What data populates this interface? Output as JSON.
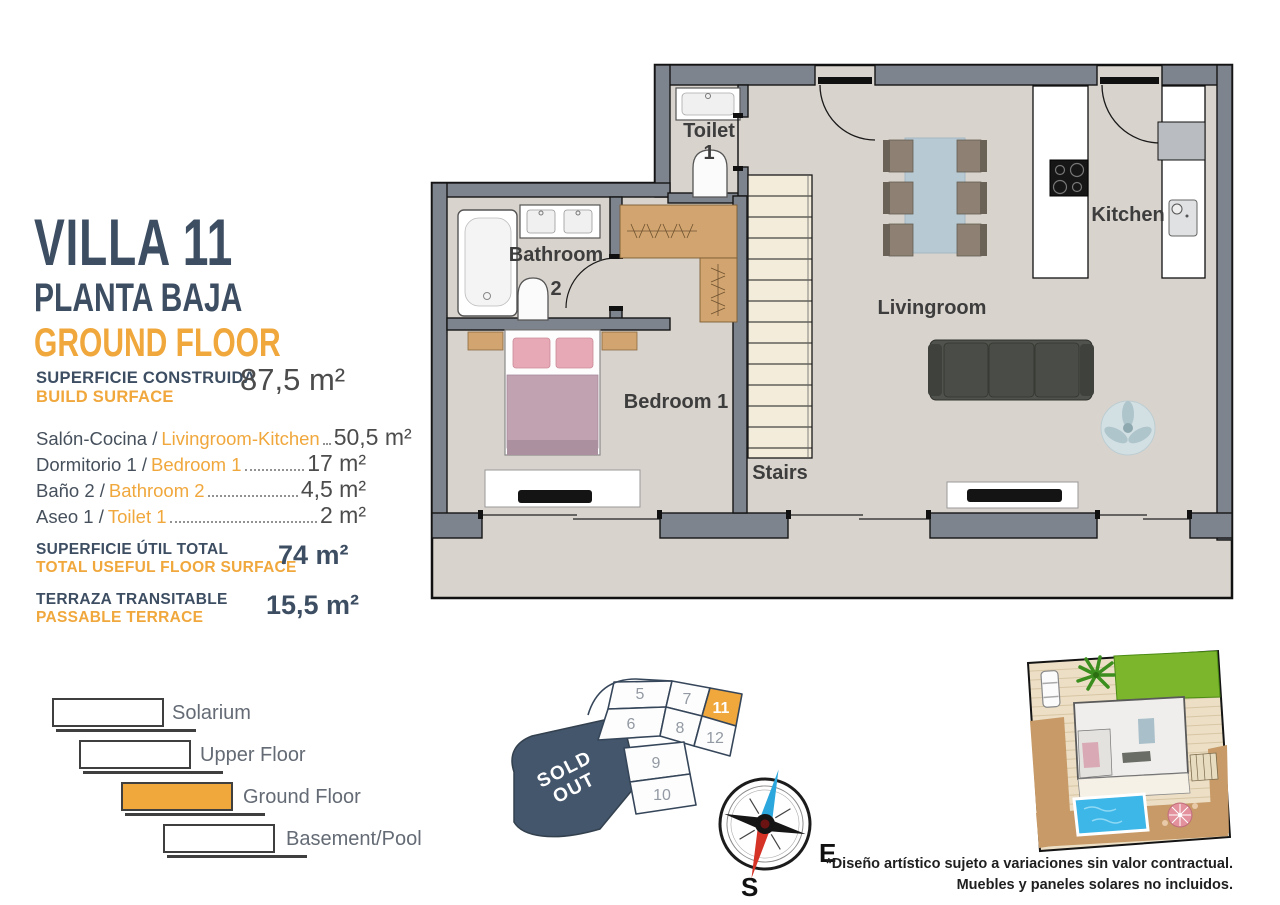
{
  "colors": {
    "navy": "#3D4E63",
    "orange": "#F0A73C",
    "wall_gray": "#7E848E",
    "floor_beige": "#D9D3CD",
    "sold_navy": "#44566C",
    "pool_blue": "#3DB6E8",
    "lawn_green": "#7CB62C",
    "stairs_cream": "#F3ECDA",
    "wood_tan": "#D2A46F"
  },
  "panel": {
    "title": "VILLA 11",
    "subtitle_es": "PLANTA BAJA",
    "subtitle_en": "GROUND FLOOR",
    "build_surface": {
      "label_es": "SUPERFICIE CONSTRUIDA",
      "label_en": "BUILD SURFACE",
      "value": "87,5 m²"
    },
    "rooms": [
      {
        "es": "Salón-Cocina /",
        "en": "Livingroom-Kitchen",
        "value": "50,5 m²"
      },
      {
        "es": "Dormitorio 1 /",
        "en": "Bedroom 1",
        "value": "17 m²"
      },
      {
        "es": "Baño 2 /",
        "en": "Bathroom 2",
        "value": "4,5 m²"
      },
      {
        "es": "Aseo 1 /",
        "en": "Toilet 1",
        "value": "2 m²"
      }
    ],
    "totals": [
      {
        "label_es": "SUPERFICIE ÚTIL TOTAL",
        "label_en": "TOTAL USEFUL FLOOR SURFACE",
        "value": "74 m²"
      },
      {
        "label_es": "TERRAZA TRANSITABLE",
        "label_en": "PASSABLE TERRACE",
        "value": "15,5 m²"
      }
    ]
  },
  "floorplan": {
    "labels": {
      "toilet_line1": "Toilet",
      "toilet_line2": "1",
      "bathroom_line1": "Bathroom",
      "bathroom_line2": "2",
      "bedroom": "Bedroom 1",
      "stairs": "Stairs",
      "livingroom": "Livingroom",
      "kitchen": "Kitchen"
    }
  },
  "legend": {
    "items": [
      {
        "label": "Solarium",
        "active": false
      },
      {
        "label": "Upper Floor",
        "active": false
      },
      {
        "label": "Ground Floor",
        "active": true
      },
      {
        "label": "Basement/Pool",
        "active": false
      }
    ]
  },
  "sitemap": {
    "units": [
      "5",
      "7",
      "11",
      "6",
      "8",
      "12",
      "9",
      "10"
    ],
    "highlighted_unit": "11",
    "sold_out_line1": "SOLD",
    "sold_out_line2": "OUT",
    "compass": {
      "east": "E",
      "south": "S"
    }
  },
  "disclaimer": {
    "line1": "*Diseño artístico sujeto a variaciones sin valor contractual.",
    "line2": "Muebles y paneles solares no incluidos."
  }
}
